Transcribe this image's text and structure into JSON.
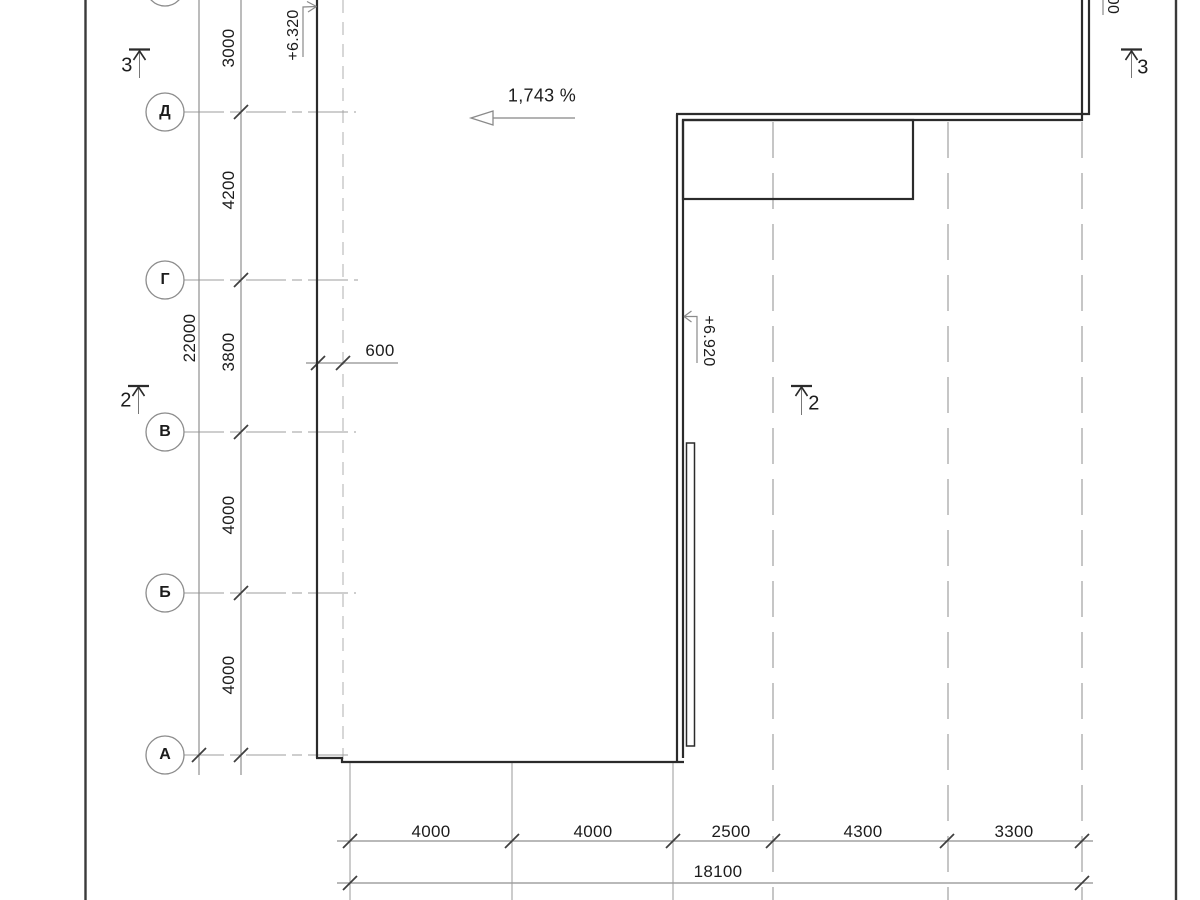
{
  "axes": {
    "rows": [
      {
        "label": "Д"
      },
      {
        "label": "Г"
      },
      {
        "label": "В"
      },
      {
        "label": "Б"
      },
      {
        "label": "А"
      }
    ]
  },
  "dimensions": {
    "left_chain": [
      "3000",
      "4200",
      "3800",
      "4000",
      "4000"
    ],
    "left_total": "22000",
    "offset": "600",
    "bottom_chain": [
      "4000",
      "4000",
      "2500",
      "4300",
      "3300"
    ],
    "bottom_total": "18100"
  },
  "annotations": {
    "slope": "1,743 %",
    "elevation_left": "+6.320",
    "elevation_right": "+6.920",
    "elevation_partial": "00",
    "sections": {
      "top_left": "3",
      "mid_left": "2",
      "mid_right": "2",
      "top_right": "3"
    }
  },
  "colors": {
    "outline": "#2b2b2b",
    "dimension": "#8f8f8f",
    "centerline": "#bdbdbd"
  }
}
